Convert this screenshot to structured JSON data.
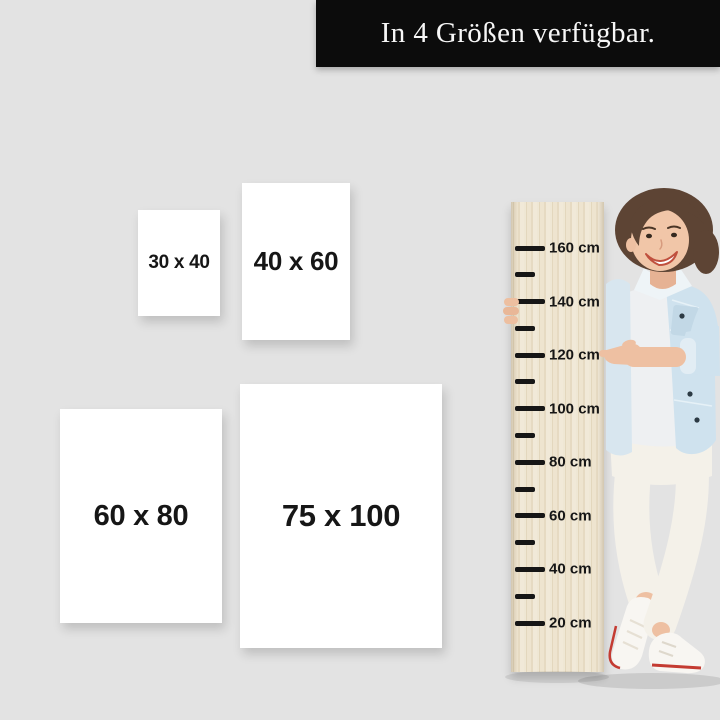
{
  "banner": {
    "text": "In 4 Größen verfügbar."
  },
  "poster_sizes": [
    {
      "label": "30 x 40"
    },
    {
      "label": "40 x 60"
    },
    {
      "label": "60 x 80"
    },
    {
      "label": "75 x 100"
    }
  ],
  "ruler": {
    "unit": "cm",
    "marks": [
      {
        "cm": 160,
        "label": "160 cm"
      },
      {
        "cm": 150
      },
      {
        "cm": 140,
        "label": "140 cm"
      },
      {
        "cm": 130
      },
      {
        "cm": 120,
        "label": "120 cm"
      },
      {
        "cm": 110
      },
      {
        "cm": 100,
        "label": "100 cm"
      },
      {
        "cm": 90
      },
      {
        "cm": 80,
        "label": "80 cm"
      },
      {
        "cm": 70
      },
      {
        "cm": 60,
        "label": "60 cm"
      },
      {
        "cm": 50
      },
      {
        "cm": 40,
        "label": "40 cm"
      },
      {
        "cm": 30
      },
      {
        "cm": 20,
        "label": "20 cm"
      }
    ]
  },
  "colors": {
    "background": "#e3e3e3",
    "banner_bg": "#0c0c0c",
    "banner_text": "#f7f7f7",
    "poster_bg": "#ffffff",
    "label_text": "#161616",
    "wood_light": "#efe7d4",
    "wood_dark": "#e3d7bd",
    "tick": "#161616",
    "skin": "#eec0a2",
    "hair": "#5d4434",
    "denim": "#cfe2ee",
    "tee": "#eef0f2",
    "pants": "#f4f1e9",
    "shoe": "#f8f6f2",
    "shoe_stripe": "#c43b32"
  }
}
